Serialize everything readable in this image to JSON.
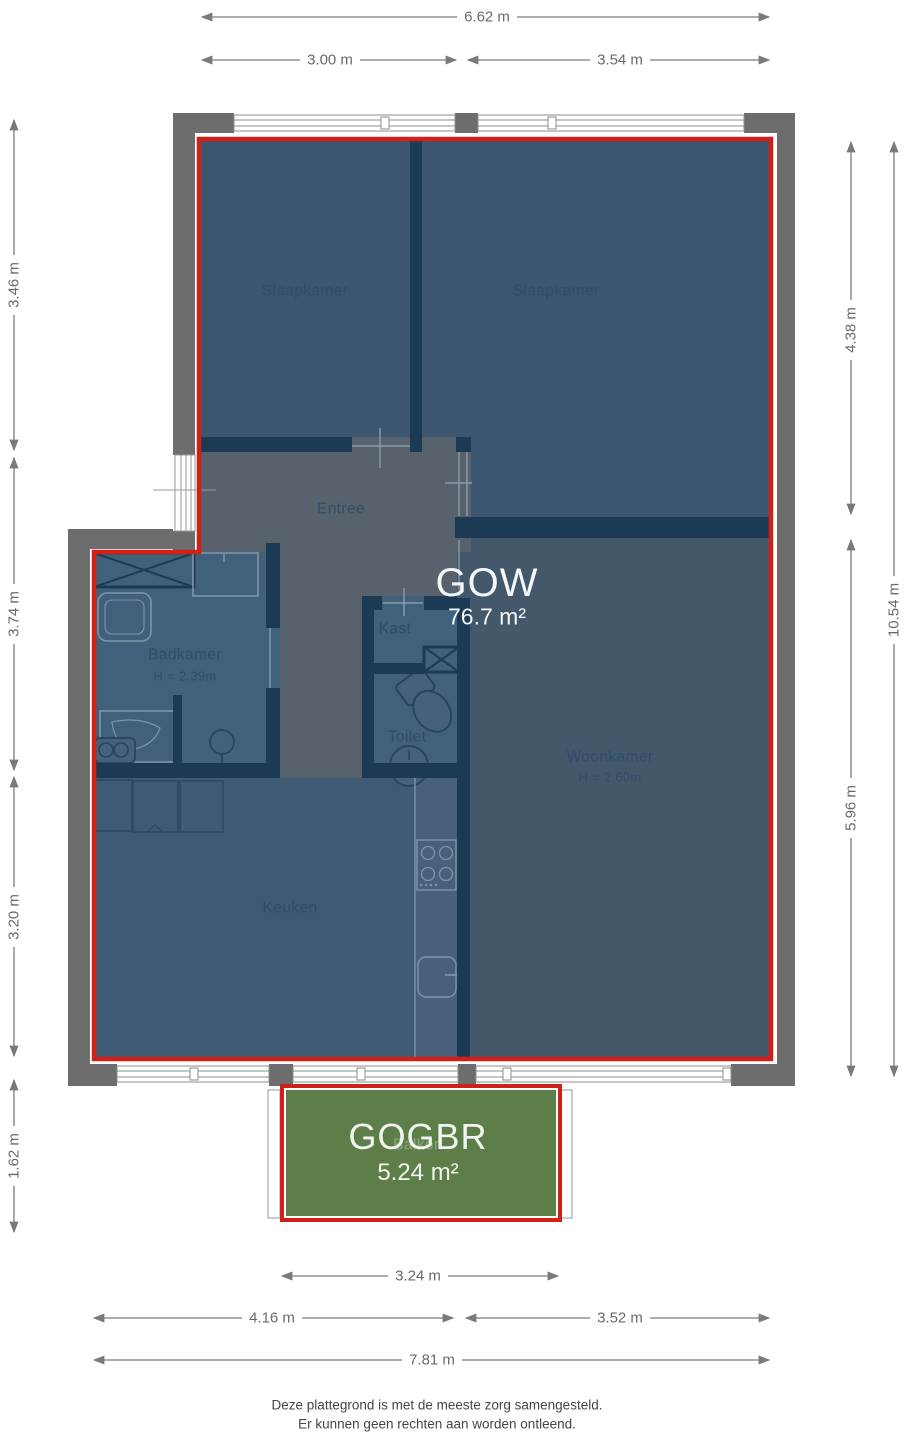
{
  "floorplan": {
    "unit": {
      "code": "GOW",
      "area": "76.7 m²"
    },
    "balcony": {
      "code": "GOGBR",
      "area": "5.24 m²",
      "room_name": "Balkon"
    },
    "rooms": {
      "slaapkamer_left": "Slaapkamer",
      "slaapkamer_right": "Slaapkamer",
      "entree": "Entree",
      "badkamer": "Badkamer",
      "badkamer_height": "H = 2.39m",
      "kast": "Kast",
      "toilet": "Toilet",
      "woonkamer": "Woonkamer",
      "woonkamer_height": "H = 2.60m",
      "keuken": "Keuken"
    },
    "dimensions": {
      "top_total": "6.62 m",
      "top_left": "3.00 m",
      "top_right": "3.54 m",
      "left_1": "3.46 m",
      "left_2": "3.74 m",
      "left_3": "3.20 m",
      "left_4": "1.62 m",
      "right_1": "4.38 m",
      "right_2": "5.96 m",
      "right_total": "10.54 m",
      "balcony_width": "3.24 m",
      "bottom_left": "4.16 m",
      "bottom_right": "3.52 m",
      "bottom_total": "7.81 m"
    },
    "footer": {
      "line1": "Deze plattegrond is met de meeste zorg samengesteld.",
      "line2": "Er kunnen geen rechten aan worden ontleend."
    },
    "colors": {
      "outline_red": "#d02119",
      "bedroom_fill": "#3d566f",
      "livingroom_fill": "#44586c",
      "wetroom_fill": "#41607a",
      "hall_fill": "#57626d",
      "wall_navy": "#1d3a55",
      "wall_gray": "#6d6d6d",
      "balcony_green": "#5e7e49",
      "dimension_gray": "#7a7a7a"
    }
  }
}
